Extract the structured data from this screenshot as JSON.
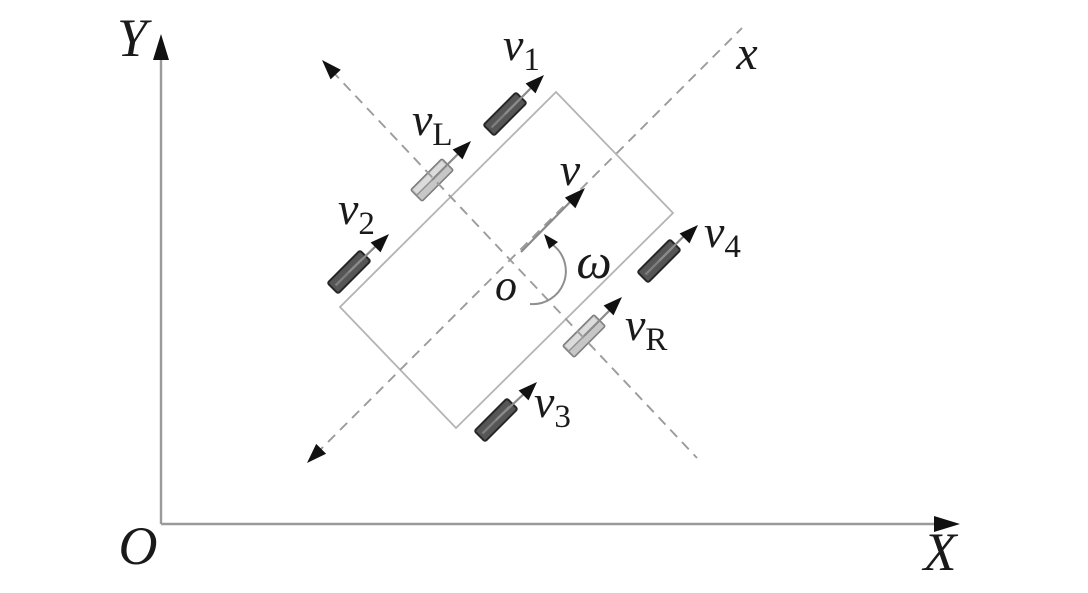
{
  "figure": {
    "global_frame": {
      "y_axis_label": "Y",
      "x_axis_label": "X",
      "origin_label": "O"
    },
    "body_frame": {
      "x_axis_label": "x",
      "origin_label": "o",
      "velocity_label": "v",
      "angular_velocity_label": "ω"
    },
    "wheels": {
      "w1": {
        "label_base": "v",
        "label_sub": "1",
        "shade": "dark"
      },
      "w2": {
        "label_base": "v",
        "label_sub": "2",
        "shade": "dark"
      },
      "w3": {
        "label_base": "v",
        "label_sub": "3",
        "shade": "dark"
      },
      "w4": {
        "label_base": "v",
        "label_sub": "4",
        "shade": "dark"
      },
      "left": {
        "label_base": "v",
        "label_sub": "L",
        "shade": "light"
      },
      "right": {
        "label_base": "v",
        "label_sub": "R",
        "shade": "light"
      }
    },
    "colors": {
      "background": "#ffffff",
      "axis_line": "#9a9a9a",
      "dashed_axis": "#9c9c9c",
      "body_outline": "#b4b4b4",
      "arrowhead": "#111111",
      "dark_wheel_fill": "#565656",
      "light_wheel_fill": "#c7c7c7",
      "text": "#1a1a1a"
    }
  }
}
